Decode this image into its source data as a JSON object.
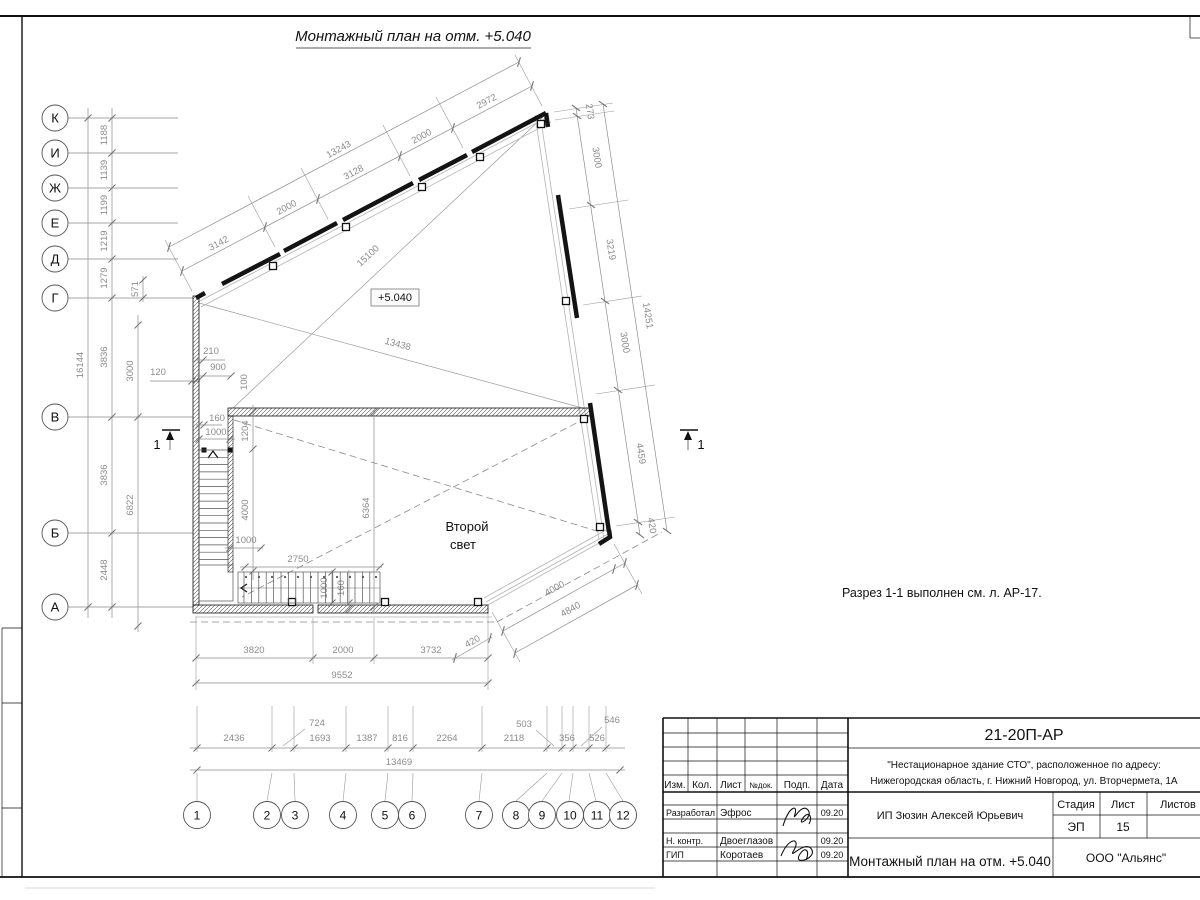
{
  "sheet": {
    "title": "Монтажный план на отм. +5.040",
    "note": "Разрез 1-1 выполнен см. л. АР-17.",
    "elevation": "+5.040",
    "second_light_1": "Второй",
    "second_light_2": "свет",
    "section_no": "1"
  },
  "axes": {
    "left": [
      "К",
      "И",
      "Ж",
      "Е",
      "Д",
      "Г",
      "В",
      "Б",
      "А"
    ],
    "bottom": [
      "1",
      "2",
      "3",
      "4",
      "5",
      "6",
      "7",
      "8",
      "9",
      "10",
      "11",
      "12"
    ]
  },
  "dims": {
    "left_axis_spacing": [
      "1188",
      "1139",
      "1199",
      "1219",
      "1279"
    ],
    "left_total": "16144",
    "left_col2": [
      "3836",
      "3836",
      "2448"
    ],
    "left_col3": [
      "3000",
      "6822"
    ],
    "left_small": [
      "571",
      "120"
    ],
    "stair_area": [
      "210",
      "900",
      "100",
      "160",
      "1000",
      "1204",
      "4000",
      "1000",
      "2750",
      "6364",
      "1000",
      "160"
    ],
    "top_chain": [
      "3142",
      "2000",
      "3128",
      "2000",
      "2972"
    ],
    "top_total": "13243",
    "diagonals": [
      "15100",
      "13438"
    ],
    "right_chain": [
      "273",
      "3000",
      "3219",
      "3000",
      "4459",
      "420"
    ],
    "right_total": "14251",
    "chamfer": [
      "4000",
      "4840",
      "420"
    ],
    "bottom_chain": [
      "3820",
      "2000",
      "3732"
    ],
    "bottom_total": "9552",
    "axis_chain": [
      "2436",
      "724",
      "1693",
      "1387",
      "816",
      "2264",
      "2118",
      "503",
      "356",
      "526",
      "546"
    ],
    "axis_total": "13469"
  },
  "titleblock": {
    "doc_number": "21-20П-АР",
    "project_line1": "\"Нестационарное здание СТО\", расположенное по адресу:",
    "project_line2": "Нижегородская область, г. Нижний Новгород, ул. Вторчермета, 1А",
    "col_izm": "Изм.",
    "col_kol": "Кол.",
    "col_list": "Лист",
    "col_ndok": "№док.",
    "col_podp": "Подп.",
    "col_data": "Дата",
    "row1_role": "Разработал",
    "row1_name": "Эфрос",
    "row1_date": "09.20",
    "row2_role": "Н. контр.",
    "row2_name": "Двоеглазов",
    "row2_date": "09.20",
    "row3_role": "ГИП",
    "row3_name": "Коротаев",
    "row3_date": "09.20",
    "client": "ИП Зюзин Алексей Юрьевич",
    "stage_label": "Стадия",
    "sheet_label": "Лист",
    "sheets_label": "Листов",
    "stage": "ЭП",
    "sheet_no": "15",
    "drawing_name": "Монтажный план на отм. +5.040",
    "company": "ООО \"Альянс\""
  }
}
